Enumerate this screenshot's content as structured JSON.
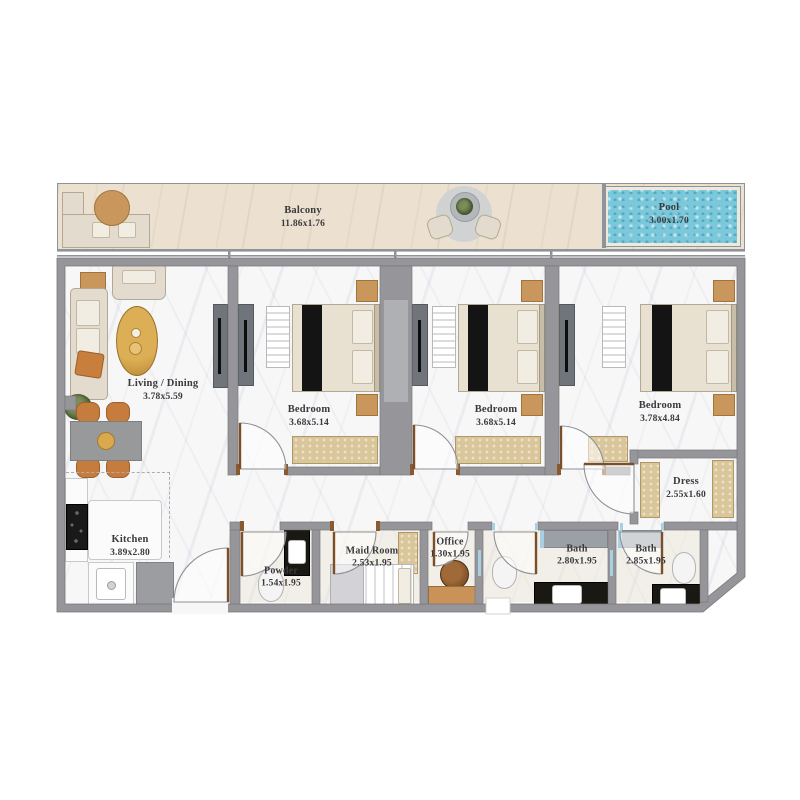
{
  "colors": {
    "wall": "#96969a",
    "pool_water": "#7bc8db",
    "balcony_floor": "#ece1d1",
    "floor_marble": "#f7f7f8",
    "wood_accent": "#c9965c",
    "rug_tan": "#d9c69b",
    "door_leaf_wood": "#7d4f28",
    "counter_black_marble": "#1a1813",
    "label_text": "#3a3a3c"
  },
  "rooms": {
    "balcony": {
      "name": "Balcony",
      "dims": "11.86x1.76"
    },
    "pool": {
      "name": "Pool",
      "dims": "3.00x1.70"
    },
    "living": {
      "name": "Living / Dining",
      "dims": "3.78x5.59"
    },
    "bedroom1": {
      "name": "Bedroom",
      "dims": "3.68x5.14"
    },
    "bedroom2": {
      "name": "Bedroom",
      "dims": "3.68x5.14"
    },
    "bedroom3": {
      "name": "Bedroom",
      "dims": "3.78x4.84"
    },
    "dress": {
      "name": "Dress",
      "dims": "2.55x1.60"
    },
    "kitchen": {
      "name": "Kitchen",
      "dims": "3.89x2.80"
    },
    "powder": {
      "name": "Powder",
      "dims": "1.54x1.95"
    },
    "maid": {
      "name": "Maid Room",
      "dims": "2.53x1.95"
    },
    "office": {
      "name": "Office",
      "dims": "1.30x1.95"
    },
    "bath1": {
      "name": "Bath",
      "dims": "2.80x1.95"
    },
    "bath2": {
      "name": "Bath",
      "dims": "2.85x1.95"
    }
  }
}
